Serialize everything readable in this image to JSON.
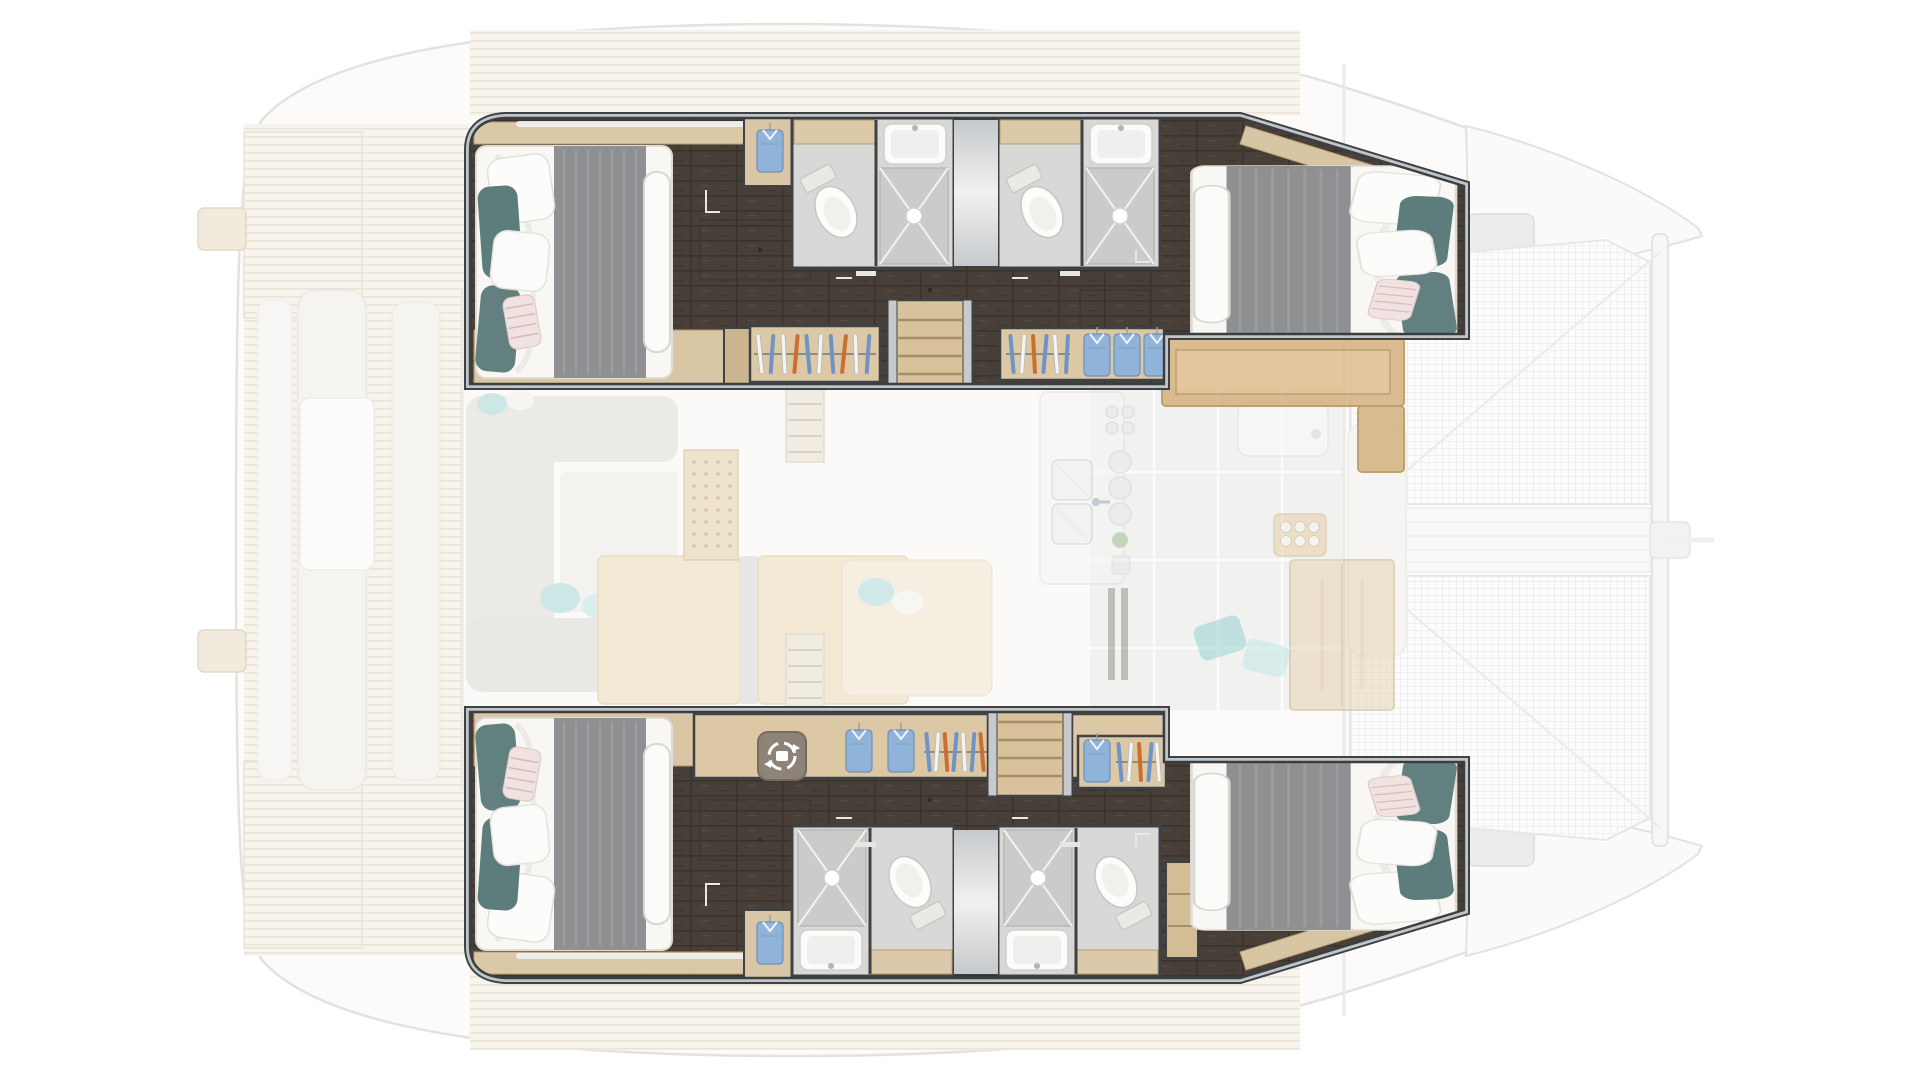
{
  "meta": {
    "title": "Catamaran yacht floor plan — 4-cabin layout, top-down view",
    "view": "top-down",
    "highlighted": "Four hull cabins with bathrooms shown at full opacity; saloon, cockpit and decks faded"
  },
  "palette": {
    "wood_light": "#dcc9a8",
    "wood_edge": "#b1976d",
    "floor_dark": "#473f38",
    "wall_gray": "#c1c5c8",
    "wall_outline": "#3e4245",
    "bed_white": "#f8f7f4",
    "blanket_gray": "#8e9092",
    "pillow_teal": "#5d7d7c",
    "pillow_soft_teal": "#9fd6d6",
    "shirt_blue": "#8fb3d9",
    "hanger_blue": "#6f93c4",
    "hanger_orange": "#c96f2f",
    "bath_floor": "#d8d8d6",
    "net_line": "#ccd2d4",
    "deck_faded": "#efe8da"
  },
  "port_hull": {
    "label": "Upper hull — aft and forward double cabins",
    "aft_cabin": "Aft double cabin with bed, teal pillows and gray blanket",
    "fwd_cabin": "Forward double cabin with bed, teal pillows and gray blanket",
    "aft_bath": "Aft bathroom: toilet, washbasin, shower tray",
    "fwd_bath": "Forward bathroom: toilet, washbasin, shower tray",
    "landing": "Entry landing between bathrooms",
    "stairs": "Companionway stairs from saloon",
    "wardrobe": "Wardrobe rail with hangers",
    "shirt_locker": "Hanging locker with folded shirts",
    "shirt_niche": "Locker niche with hanging blue shirt",
    "corridor": "Dark wengé floor corridor"
  },
  "starboard_hull": {
    "label": "Lower hull — aft and forward double cabins",
    "aft_cabin": "Aft double cabin with bed, teal pillows and gray blanket",
    "fwd_cabin": "Forward double cabin with bed, teal pillows and gray blanket",
    "aft_bath": "Aft bathroom: shower tray, washbasin, toilet",
    "fwd_bath": "Forward bathroom: shower tray, washbasin, toilet",
    "landing": "Entry landing between bathrooms",
    "stairs": "Companionway stairs from saloon",
    "desk": "Dressing desk with laundry icon, hanging shirts and hangers",
    "wardrobe": "Wardrobe rail with hangers and shirt",
    "shirt_niche": "Locker niche with hanging blue shirt",
    "corridor": "Dark wengé floor corridor"
  },
  "saloon": {
    "label": "Saloon (faded)",
    "sofa": "U-shaped lounge sofa with cushions",
    "tables": "Saloon tables",
    "cabinet": "Louvered locker cabinet",
    "steps": "Saloon entry steps",
    "galley": "Galley: double sink, burners, worktop",
    "galley_counter": "Galley wood counter",
    "tall_locker": "Tall galley locker",
    "nav_table": "Forward table",
    "tray": "Glass tray",
    "cushions": "Scatter cushions"
  },
  "exterior": {
    "label": "Exterior decks (faded)",
    "cockpit": "Aft cockpit with benches and table",
    "swim_platforms": "Stern swim platforms",
    "davits": "Stern davit blocks",
    "side_decks": "Teak side decks",
    "hatches": "Foredeck hatches",
    "trampoline_top": "Bow trampoline net (upper)",
    "trampoline_bottom": "Bow trampoline net (lower)",
    "walkway": "Bow center walkway",
    "crossbeam": "Forward crossbeam and bowsprit",
    "bow_top": "Upper hull bow",
    "bow_bottom": "Lower hull bow"
  }
}
